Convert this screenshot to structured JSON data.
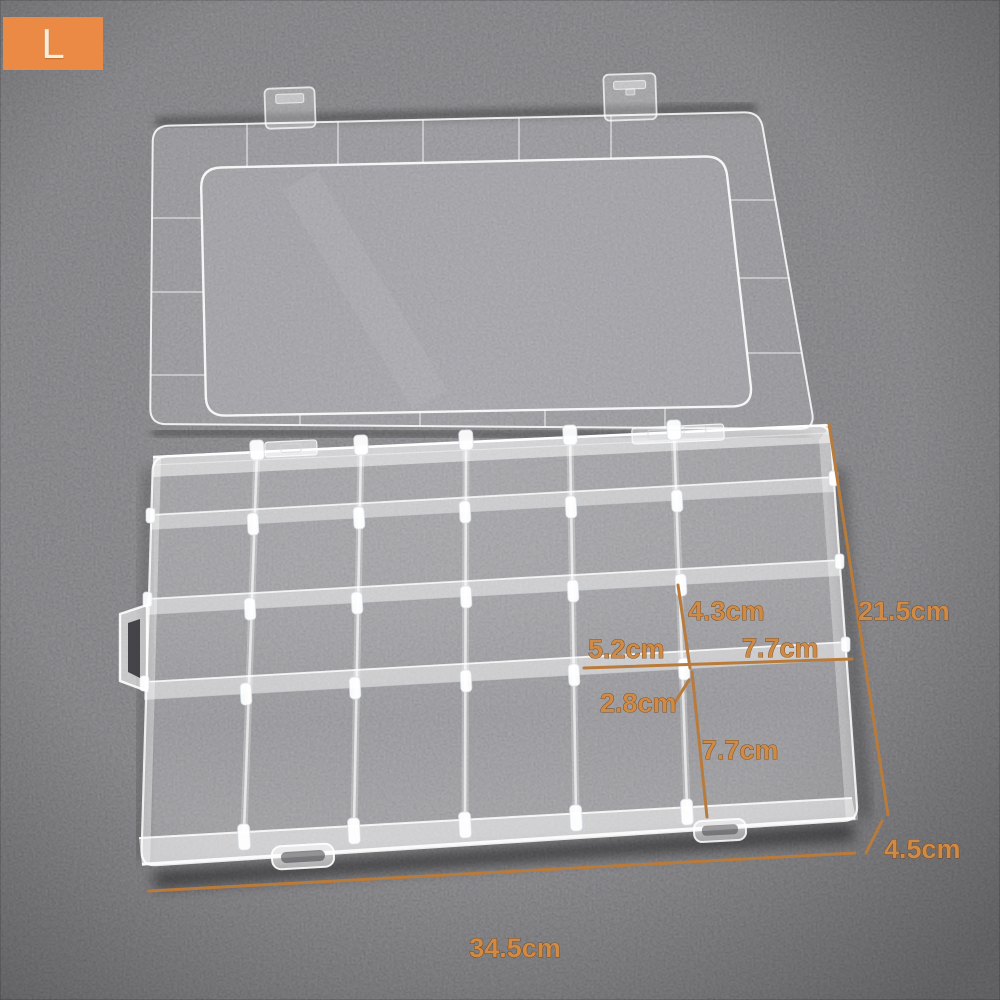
{
  "badge": {
    "label": "L",
    "background_color": "#ea8a44",
    "text_color": "#f6eedd"
  },
  "scene": {
    "background_color": "#323136",
    "annotation_text_color": "#cf8a45",
    "annotation_line_color": "#b87b3c",
    "plastic_color": "#ffffff"
  },
  "annotations": {
    "labels": [
      {
        "id": "cell-height",
        "text": "4.3cm"
      },
      {
        "id": "box-side-depth",
        "text": "21.5cm"
      },
      {
        "id": "cell-width",
        "text": "5.2cm"
      },
      {
        "id": "right-column-width",
        "text": "7.7cm"
      },
      {
        "id": "divider-height",
        "text": "2.8cm"
      },
      {
        "id": "bottom-row-height",
        "text": "7.7cm"
      },
      {
        "id": "box-height",
        "text": "4.5cm"
      },
      {
        "id": "box-width",
        "text": "34.5cm"
      }
    ]
  }
}
